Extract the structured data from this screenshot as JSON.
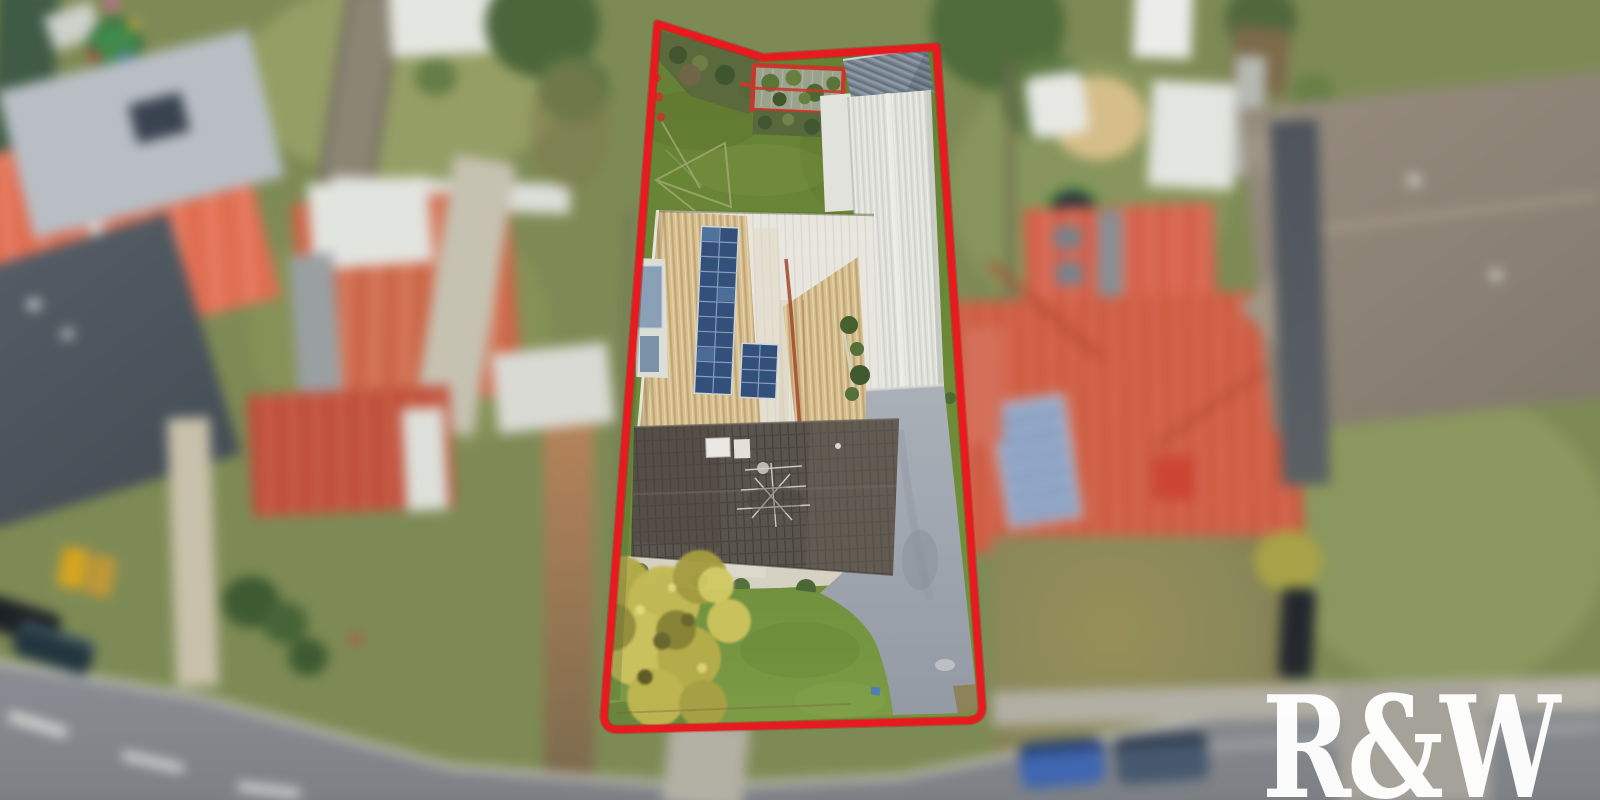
{
  "watermark": {
    "text": "R&W"
  },
  "palette": {
    "boundary_red": "#e8191f",
    "watermark_white": "#ffffff",
    "backyard_lawn": "#65832f",
    "front_lawn": "#6f8f3d",
    "tan_roof": "#d7c093",
    "white_roof": "#e7e5de",
    "grey_metal_roof": "#76828e",
    "dark_tile_roof": "#59544c",
    "driveway": "#9aa1ab",
    "solar_panel": "#32507a",
    "autumn_tree": "#c3ba54",
    "road": "#85888d",
    "neighbour_coral_roof": "#e06e52",
    "neighbour_terracotta_roof": "#cd5a40",
    "neighbour_slate_roof": "#4a525a",
    "neighbour_taupe_roof": "#8a8073"
  },
  "scene": {
    "type": "aerial-drone-photo",
    "subject": "residential lot outlined in red",
    "lot_features": [
      "back lawn",
      "red-framed pergola",
      "grey metal shed roof",
      "long white workshop roof",
      "tan corrugated roof with solar panel arrays",
      "dark tiled house roof with tv antenna",
      "pebble garden beds",
      "autumn tree",
      "front lawn",
      "concrete driveway"
    ],
    "surroundings": [
      "neighbouring houses and backyards",
      "curved street with parked cars",
      "footpaths",
      "playground",
      "trampoline",
      "sandpit"
    ]
  }
}
